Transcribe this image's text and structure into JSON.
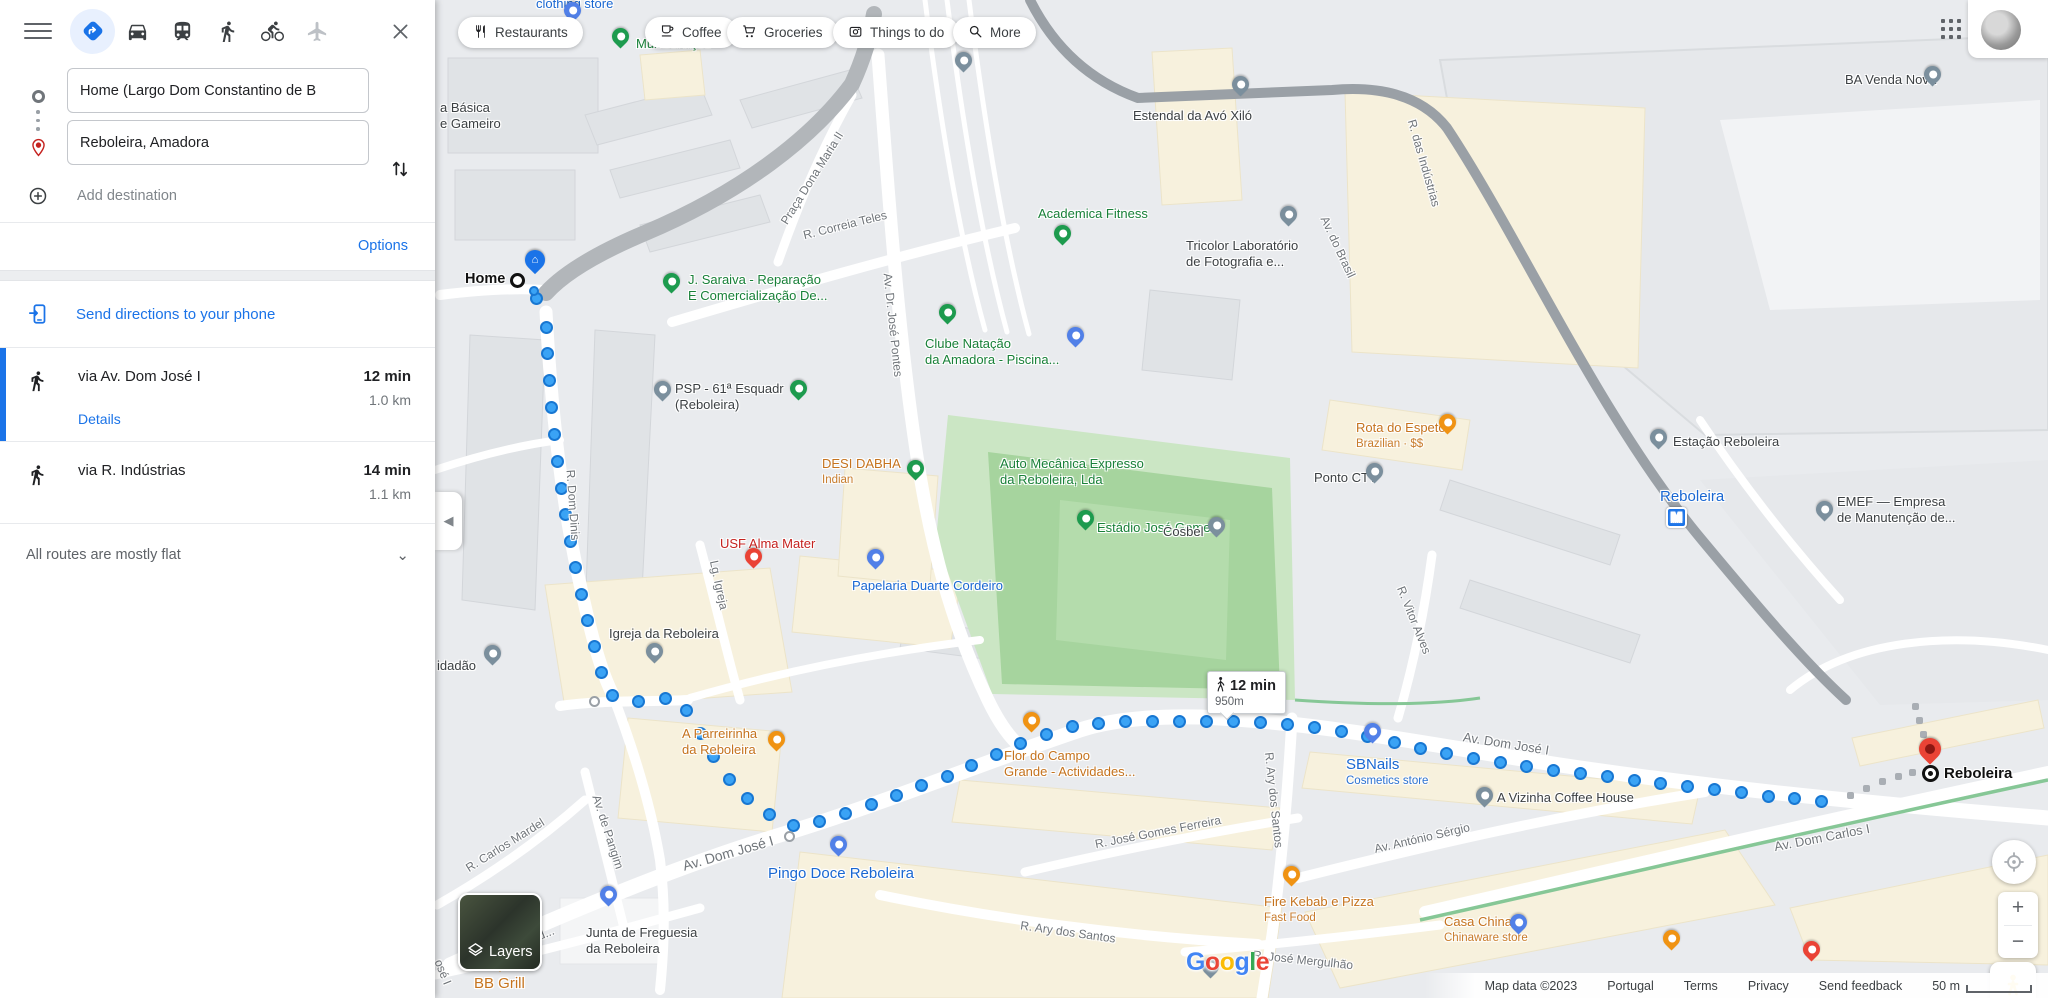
{
  "app": {
    "title": "Google Maps walking directions"
  },
  "sidebar": {
    "modes": [
      {
        "id": "best",
        "selected": true
      },
      {
        "id": "driving",
        "selected": false
      },
      {
        "id": "transit",
        "selected": false
      },
      {
        "id": "walking",
        "selected": false
      },
      {
        "id": "cycling",
        "selected": false
      },
      {
        "id": "flight",
        "selected": false
      }
    ],
    "origin": {
      "value": "Home (Largo Dom Constantino de B"
    },
    "destination": {
      "value": "Reboleira, Amadora"
    },
    "add_destination_label": "Add destination",
    "options_label": "Options",
    "send_label": "Send directions to your phone",
    "routes": [
      {
        "via": "via Av. Dom José I",
        "duration": "12 min",
        "distance": "1.0 km",
        "details_label": "Details"
      },
      {
        "via": "via R. Indústrias",
        "duration": "14 min",
        "distance": "1.1 km"
      }
    ],
    "flat_note": "All routes are mostly flat"
  },
  "map": {
    "chips": [
      {
        "label": "Restaurants",
        "icon": "restaurant",
        "x": 458
      },
      {
        "label": "Coffee",
        "icon": "coffee",
        "x": 645
      },
      {
        "label": "Groceries",
        "icon": "grocery",
        "x": 727
      },
      {
        "label": "Things to do",
        "icon": "attraction",
        "x": 833
      },
      {
        "label": "More",
        "icon": "search",
        "x": 953
      }
    ],
    "metro_letter": "M",
    "tooltip": {
      "duration": "12 min",
      "distance": "950m"
    },
    "home": {
      "label": "Home"
    },
    "destination": {
      "label": "Reboleira"
    },
    "layers_label": "Layers",
    "google_logo": "Google",
    "attribution": {
      "map_data": "Map data ©2023",
      "region": "Portugal",
      "terms": "Terms",
      "privacy": "Privacy",
      "feedback": "Send feedback",
      "scale": "50 m"
    },
    "labels": [
      {
        "id": "clothing-store",
        "type": "poi-blue",
        "x": 536,
        "y": -4,
        "lines": [
          "clothing store"
        ]
      },
      {
        "id": "multiservicos",
        "type": "poi-green",
        "x": 636,
        "y": 36,
        "lines": [
          "Multiserviços"
        ]
      },
      {
        "id": "escola-basica",
        "type": "poi-dark",
        "x": 440,
        "y": 100,
        "lines": [
          "a Básica",
          "e Gameiro"
        ]
      },
      {
        "id": "j-saraiva",
        "type": "poi-green",
        "x": 688,
        "y": 272,
        "lines": [
          "J. Saraiva - Reparação",
          "E Comercialização De..."
        ]
      },
      {
        "id": "estendal-avo-xilo",
        "type": "poi-dark",
        "x": 1133,
        "y": 108,
        "lines": [
          "Estendal da Avó Xiló"
        ]
      },
      {
        "id": "academica-fitness",
        "type": "poi-green",
        "x": 1038,
        "y": 206,
        "lines": [
          "Academica Fitness"
        ]
      },
      {
        "id": "tricolor-laboratorio",
        "type": "poi-dark",
        "x": 1186,
        "y": 238,
        "lines": [
          "Tricolor Laboratório",
          "de Fotografia e..."
        ]
      },
      {
        "id": "ba-venda-nova",
        "type": "poi-dark",
        "x": 1845,
        "y": 72,
        "lines": [
          "BA Venda Nova"
        ]
      },
      {
        "id": "clube-natacao",
        "type": "poi-green",
        "x": 925,
        "y": 336,
        "lines": [
          "Clube Natação",
          "da Amadora -  Piscina..."
        ]
      },
      {
        "id": "psp-esquadra",
        "type": "poi-dark",
        "x": 675,
        "y": 381,
        "lines": [
          "PSP - 61ª Esquadr",
          "(Reboleira)"
        ]
      },
      {
        "id": "desi-dabha",
        "type": "poi-orange",
        "x": 822,
        "y": 456,
        "lines": [
          "DESI DABHA"
        ],
        "sub": "Indian"
      },
      {
        "id": "auto-mecanica",
        "type": "poi-green",
        "x": 1000,
        "y": 456,
        "lines": [
          "Auto Mecânica Expresso",
          "da Reboleira, Lda"
        ]
      },
      {
        "id": "estadio-jose-gomes",
        "type": "poi-green",
        "x": 1097,
        "y": 520,
        "lines": [
          "Estádio José Gomes"
        ]
      },
      {
        "id": "rota-do-espeto",
        "type": "poi-orange",
        "x": 1356,
        "y": 420,
        "lines": [
          "Rota do Espeto"
        ],
        "sub": "Brazilian · $$"
      },
      {
        "id": "ponto-ctt",
        "type": "poi-dark",
        "x": 1314,
        "y": 470,
        "lines": [
          "Ponto CTT"
        ]
      },
      {
        "id": "cosbel",
        "type": "poi-dark",
        "x": 1163,
        "y": 524,
        "lines": [
          "Cosbel"
        ]
      },
      {
        "id": "estacao-reboleira",
        "type": "poi-dark",
        "x": 1673,
        "y": 434,
        "lines": [
          "Estação Reboleira"
        ]
      },
      {
        "id": "reboleira-metro",
        "type": "poi-blue",
        "x": 1660,
        "y": 489,
        "lines": [
          "Reboleira"
        ],
        "metro": true,
        "big": true
      },
      {
        "id": "emef",
        "type": "poi-dark",
        "x": 1837,
        "y": 494,
        "lines": [
          "EMEF — Empresa",
          "de Manutenção de..."
        ]
      },
      {
        "id": "usf-alma-mater",
        "type": "poi-red",
        "x": 720,
        "y": 536,
        "lines": [
          "USF Alma Mater"
        ]
      },
      {
        "id": "igreja-da-reboleira",
        "type": "poi-dark",
        "x": 609,
        "y": 626,
        "lines": [
          "Igreja da Reboleira"
        ]
      },
      {
        "id": "espaco-cidadao",
        "type": "poi-dark",
        "x": 437,
        "y": 658,
        "lines": [
          "idadão"
        ]
      },
      {
        "id": "papelaria-duarte",
        "type": "poi-blue",
        "x": 852,
        "y": 578,
        "lines": [
          "Papelaria Duarte Cordeiro"
        ]
      },
      {
        "id": "a-parreirinha",
        "type": "poi-orange",
        "x": 682,
        "y": 726,
        "lines": [
          "A Parreirinha",
          "da Reboleira"
        ]
      },
      {
        "id": "flor-do-campo",
        "type": "poi-orange",
        "x": 1004,
        "y": 748,
        "lines": [
          "Flor do Campo",
          "Grande - Actividades..."
        ]
      },
      {
        "id": "sbnails",
        "type": "poi-blue",
        "x": 1346,
        "y": 757,
        "lines": [
          "SBNails"
        ],
        "sub": "Cosmetics store",
        "big": true
      },
      {
        "id": "a-vizinha",
        "type": "poi-dark",
        "x": 1497,
        "y": 790,
        "lines": [
          "A Vizinha Coffee House"
        ]
      },
      {
        "id": "fire-kebab",
        "type": "poi-orange",
        "x": 1264,
        "y": 894,
        "lines": [
          "Fire Kebab e Pizza"
        ],
        "sub": "Fast Food"
      },
      {
        "id": "pingo-doce",
        "type": "poi-blue",
        "x": 768,
        "y": 866,
        "lines": [
          "Pingo Doce Reboleira"
        ],
        "big": true
      },
      {
        "id": "junta-freguesia",
        "type": "poi-dark",
        "x": 586,
        "y": 925,
        "lines": [
          "Junta de Freguesia",
          "da Reboleira"
        ]
      },
      {
        "id": "bb-grill",
        "type": "poi-orange",
        "x": 474,
        "y": 976,
        "lines": [
          "BB Grill"
        ],
        "big": true
      },
      {
        "id": "casa-china",
        "type": "poi-orange",
        "x": 1444,
        "y": 914,
        "lines": [
          "Casa China"
        ],
        "sub": "Chinaware store"
      },
      {
        "id": "st-praca-dona-maria",
        "type": "street",
        "x": 812,
        "y": 178,
        "rot": -58,
        "lines": [
          "Praça Dona Maria II"
        ]
      },
      {
        "id": "st-correia-teles",
        "type": "street",
        "x": 845,
        "y": 225,
        "rot": -14,
        "lines": [
          "R. Correia Teles"
        ]
      },
      {
        "id": "st-jose-pontes",
        "type": "street",
        "x": 893,
        "y": 325,
        "rot": 84,
        "lines": [
          "Av. Dr. José Pontes"
        ]
      },
      {
        "id": "st-av-brasil",
        "type": "street",
        "x": 1338,
        "y": 247,
        "rot": 65,
        "lines": [
          "Av. do Brasil"
        ]
      },
      {
        "id": "st-industrias",
        "type": "street",
        "x": 1424,
        "y": 163,
        "rot": 74,
        "lines": [
          "R. das Indústrias"
        ]
      },
      {
        "id": "st-vitor-alves",
        "type": "street",
        "x": 1414,
        "y": 620,
        "rot": 68,
        "lines": [
          "R. Vitor Alves"
        ]
      },
      {
        "id": "st-lg-igreja",
        "type": "street",
        "x": 719,
        "y": 585,
        "rot": 78,
        "lines": [
          "Lg. Igreja"
        ]
      },
      {
        "id": "st-dom-dinis",
        "type": "street",
        "x": 573,
        "y": 505,
        "rot": 86,
        "lines": [
          "R. Dom Dinis"
        ]
      },
      {
        "id": "st-pangim",
        "type": "street",
        "x": 608,
        "y": 832,
        "rot": 72,
        "lines": [
          "Av. de Pangim"
        ]
      },
      {
        "id": "st-carlos-mardel",
        "type": "street",
        "x": 505,
        "y": 845,
        "rot": -32,
        "lines": [
          "R. Carlos Mardel"
        ]
      },
      {
        "id": "st-av-dom-jose-sw",
        "type": "street",
        "x": 728,
        "y": 853,
        "rot": -16,
        "size": 14,
        "lines": [
          "Av. Dom José I"
        ]
      },
      {
        "id": "st-av-dom-jose-e",
        "type": "street",
        "x": 1506,
        "y": 744,
        "rot": 9,
        "size": 13,
        "lines": [
          "Av. Dom José I"
        ]
      },
      {
        "id": "st-av-dom-carlos",
        "type": "street",
        "x": 1822,
        "y": 838,
        "rot": -11,
        "size": 13,
        "lines": [
          "Av. Dom Carlos I"
        ]
      },
      {
        "id": "st-antonio-sergio",
        "type": "street",
        "x": 1422,
        "y": 838,
        "rot": -13,
        "lines": [
          "Av. António Sérgio"
        ]
      },
      {
        "id": "st-gomes-ferreira",
        "type": "street",
        "x": 1158,
        "y": 832,
        "rot": -11,
        "lines": [
          "R. José Gomes Ferreira"
        ]
      },
      {
        "id": "st-ary-santos-v",
        "type": "street",
        "x": 1274,
        "y": 800,
        "rot": 84,
        "lines": [
          "R. Ary dos Santos"
        ]
      },
      {
        "id": "st-ary-santos-h",
        "type": "street",
        "x": 1068,
        "y": 932,
        "rot": 8,
        "lines": [
          "R. Ary dos Santos"
        ]
      },
      {
        "id": "st-herculano",
        "type": "street",
        "x": 512,
        "y": 947,
        "rot": -22,
        "lines": [
          "R. Herculano d..."
        ]
      },
      {
        "id": "st-mergulhao",
        "type": "street",
        "x": 1303,
        "y": 960,
        "rot": 6,
        "lines": [
          "R. José Mergulhão"
        ]
      },
      {
        "id": "st-jose-i",
        "type": "street",
        "x": 443,
        "y": 972,
        "rot": 68,
        "lines": [
          "osé I"
        ]
      }
    ],
    "pins": [
      {
        "id": "pin-clothing",
        "kind": "blue",
        "x": 572,
        "y": 10
      },
      {
        "id": "pin-multiservicos",
        "kind": "green",
        "x": 620,
        "y": 36
      },
      {
        "id": "pin-gray-top",
        "kind": "gray",
        "x": 963,
        "y": 60
      },
      {
        "id": "pin-j-saraiva",
        "kind": "green-flag",
        "x": 671,
        "y": 281
      },
      {
        "id": "pin-estendal",
        "kind": "gray",
        "x": 1240,
        "y": 84
      },
      {
        "id": "pin-academica",
        "kind": "green",
        "x": 1062,
        "y": 233
      },
      {
        "id": "pin-tricolor",
        "kind": "gray",
        "x": 1288,
        "y": 214
      },
      {
        "id": "pin-ba-venda",
        "kind": "gray",
        "x": 1932,
        "y": 74
      },
      {
        "id": "pin-clube",
        "kind": "green",
        "x": 947,
        "y": 312
      },
      {
        "id": "pin-psp",
        "kind": "gray",
        "x": 662,
        "y": 389
      },
      {
        "id": "pin-flag-1",
        "kind": "green-flag",
        "x": 798,
        "y": 388
      },
      {
        "id": "pin-desi-auto",
        "kind": "green-flag",
        "x": 915,
        "y": 468
      },
      {
        "id": "pin-estadio",
        "kind": "green",
        "x": 1085,
        "y": 518
      },
      {
        "id": "pin-rota",
        "kind": "orange",
        "x": 1447,
        "y": 422
      },
      {
        "id": "pin-ctt",
        "kind": "gray",
        "x": 1374,
        "y": 471
      },
      {
        "id": "pin-cosbel",
        "kind": "gray",
        "x": 1216,
        "y": 525
      },
      {
        "id": "pin-estacao",
        "kind": "gray",
        "x": 1658,
        "y": 437
      },
      {
        "id": "pin-emef",
        "kind": "gray",
        "x": 1824,
        "y": 509
      },
      {
        "id": "pin-usf",
        "kind": "red",
        "x": 753,
        "y": 556
      },
      {
        "id": "pin-igreja",
        "kind": "gray",
        "x": 654,
        "y": 651
      },
      {
        "id": "pin-cidadao",
        "kind": "gray",
        "x": 492,
        "y": 653
      },
      {
        "id": "pin-papelaria",
        "kind": "blue",
        "x": 875,
        "y": 557
      },
      {
        "id": "pin-parreirinha",
        "kind": "orange",
        "x": 776,
        "y": 739
      },
      {
        "id": "pin-flor",
        "kind": "orange",
        "x": 1031,
        "y": 720
      },
      {
        "id": "pin-sbnails",
        "kind": "blue",
        "x": 1372,
        "y": 731
      },
      {
        "id": "pin-vizinha",
        "kind": "gray",
        "x": 1484,
        "y": 795
      },
      {
        "id": "pin-kebab",
        "kind": "orange",
        "x": 1291,
        "y": 874
      },
      {
        "id": "pin-pingo",
        "kind": "blue",
        "x": 838,
        "y": 844
      },
      {
        "id": "pin-junta",
        "kind": "blue",
        "x": 608,
        "y": 894
      },
      {
        "id": "pin-bbgrill",
        "kind": "orange-tri",
        "x": 500,
        "y": 968
      },
      {
        "id": "pin-casa-china",
        "kind": "blue",
        "x": 1518,
        "y": 922
      },
      {
        "id": "pin-shop-mid",
        "kind": "blue",
        "x": 1075,
        "y": 335
      },
      {
        "id": "pin-google-s",
        "kind": "gray",
        "x": 1210,
        "y": 966
      },
      {
        "id": "pin-red-se",
        "kind": "red",
        "x": 1811,
        "y": 949
      },
      {
        "id": "pin-coffee-se",
        "kind": "orange",
        "x": 1671,
        "y": 938
      }
    ],
    "route": {
      "spacing": 27,
      "points": [
        [
          546,
          327
        ],
        [
          549,
          375
        ],
        [
          554,
          430
        ],
        [
          561,
          487
        ],
        [
          570,
          540
        ],
        [
          581,
          592
        ],
        [
          592,
          638
        ],
        [
          601,
          672
        ],
        [
          607,
          692
        ],
        [
          622,
          701
        ],
        [
          650,
          701
        ],
        [
          673,
          697
        ],
        [
          688,
          712
        ],
        [
          706,
          744
        ],
        [
          725,
          775
        ],
        [
          746,
          797
        ],
        [
          766,
          812
        ],
        [
          780,
          822
        ],
        [
          800,
          827
        ],
        [
          830,
          818
        ],
        [
          868,
          806
        ],
        [
          908,
          791
        ],
        [
          948,
          776
        ],
        [
          988,
          758
        ],
        [
          1028,
          740
        ],
        [
          1068,
          727
        ],
        [
          1108,
          722
        ],
        [
          1158,
          721
        ],
        [
          1208,
          721
        ],
        [
          1258,
          722
        ],
        [
          1308,
          726
        ],
        [
          1358,
          734
        ],
        [
          1408,
          746
        ],
        [
          1458,
          756
        ],
        [
          1508,
          764
        ],
        [
          1558,
          771
        ],
        [
          1608,
          777
        ],
        [
          1658,
          783
        ],
        [
          1708,
          789
        ],
        [
          1758,
          795
        ],
        [
          1808,
          800
        ],
        [
          1838,
          803
        ]
      ],
      "start_dot": [
        536,
        298
      ],
      "via_circles": [
        [
          594,
          701
        ],
        [
          789,
          836
        ]
      ],
      "gray_dots": [
        [
          1850,
          795
        ],
        [
          1866,
          788
        ],
        [
          1882,
          781
        ],
        [
          1898,
          776
        ],
        [
          1912,
          772
        ],
        [
          1915,
          706
        ],
        [
          1919,
          720
        ],
        [
          1923,
          734
        ],
        [
          1926,
          748
        ]
      ]
    }
  }
}
